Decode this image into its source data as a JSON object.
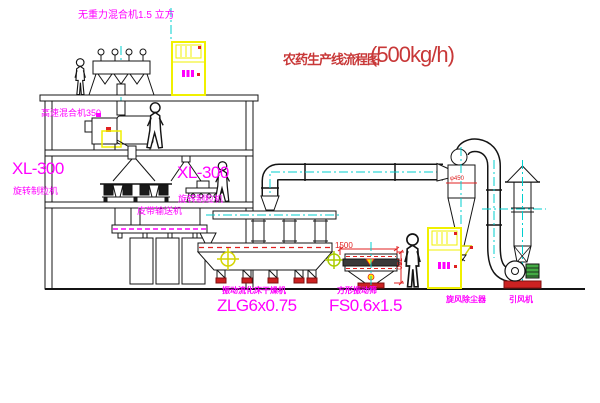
{
  "title": {
    "name_cn": "农药生产线流程图",
    "capacity": "(500kg/h)"
  },
  "labels": {
    "top_mixer": "无重力混合机1.5 立方",
    "high_speed_mixer": "高速混合机350",
    "granulator_left_model": "XL-300",
    "granulator_left_name": "旋转制粒机",
    "granulator_right_model": "XL-300",
    "granulator_right_name": "旋转制粒机",
    "belt_conveyor": "皮带输送机",
    "dryer_name": "振动流化床干燥机",
    "dryer_model": "ZLG6x0.75",
    "sieve_name": "方形振动筛",
    "sieve_model": "FS0.6x1.5",
    "cyclone": "旋风除尘器",
    "induced_draft_fan": "引风机"
  },
  "dimensions": {
    "sieve_length": "1500",
    "sieve_height": "750",
    "cyclone_diameter": "φ450"
  },
  "colors": {
    "line": "#141414",
    "centerline_cyan": "#00cfcf",
    "label_magenta": "#ff00ff",
    "title_red": "#c83838",
    "dimension_red": "#e02020",
    "cabinet_yellow": "#f0f000",
    "symbol_yellow": "#d4d400",
    "motor_green": "#44aa44",
    "base_red": "#cc2222"
  }
}
